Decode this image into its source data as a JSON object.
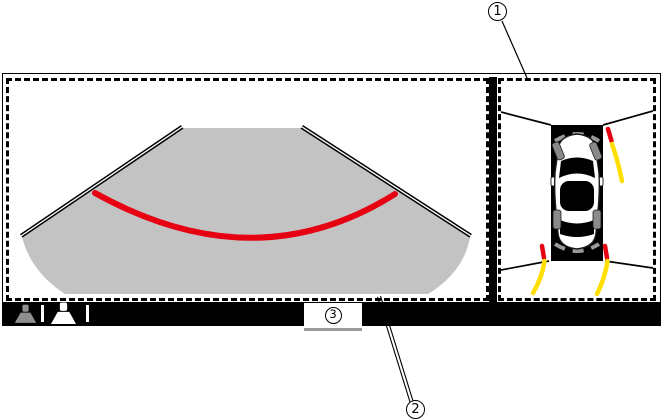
{
  "diagram": {
    "title": "around-view-monitor-screen",
    "callouts": {
      "c1": "1",
      "c2": "2",
      "c3": "3"
    },
    "panels": {
      "left": "rear-camera-wide-view",
      "right": "birds-eye-top-view"
    },
    "colors": {
      "view_area_gray": "#c3c3c3",
      "distance_guide_red": "#e60012",
      "predicted_course_yellow": "#ffdf00",
      "bar_background": "#000000",
      "vehicle_shadow_black": "#000000",
      "wheel_gray": "#8a8a8a",
      "sonar_arc_gray": "#9a9a9a"
    },
    "bottom_bar": {
      "icons": [
        {
          "name": "rear-camera-icon",
          "state": "inactive",
          "color": "#8f8f8f"
        },
        {
          "name": "wide-view-camera-icon",
          "state": "active",
          "color": "#ffffff"
        }
      ]
    }
  }
}
